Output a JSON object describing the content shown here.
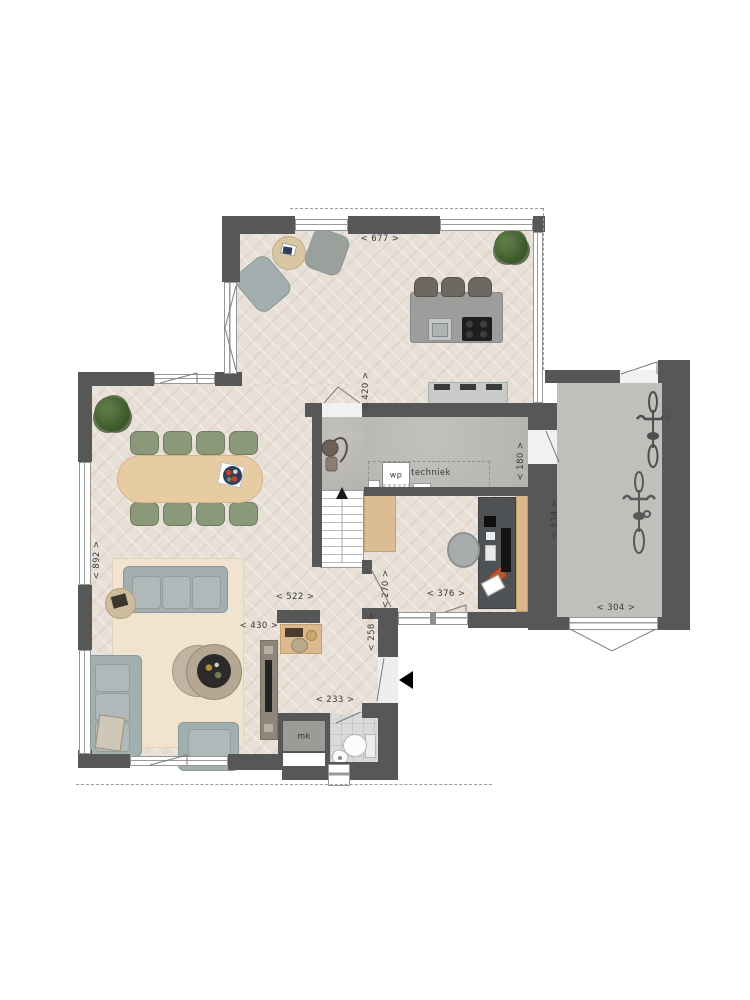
{
  "floorplan": {
    "dimensions": {
      "top_width": "< 677 >",
      "kitchen_depth": "< 420 >",
      "left_height": "< 892 >",
      "living_width": "< 522 >",
      "living_inner_width": "< 430 >",
      "hall_depth": "< 270 >",
      "hall_side": "< 258 >",
      "hall_length": "< 233 >",
      "study_width": "< 376 >",
      "passage_width": "< 180 >",
      "garage_depth": "< 534 >",
      "garage_width": "< 304 >"
    },
    "room_labels": {
      "techniek": "techniek"
    },
    "fixture_labels": {
      "wp": "wp",
      "mk": "mk"
    },
    "colors": {
      "wall": "#575757",
      "wood_floor": "#e8dfd7",
      "concrete_floor": "#bcbab6",
      "tile_floor": "#dadad8",
      "rug": "#f0e4d0",
      "sofa": "#a3aeae",
      "dining_chair": "#8b9879",
      "table_wood": "#e7cba2",
      "kitchen_island": "#9d9e9b",
      "desk": "#4e5254",
      "plant": "#42602f",
      "arrow": "#000000"
    }
  }
}
